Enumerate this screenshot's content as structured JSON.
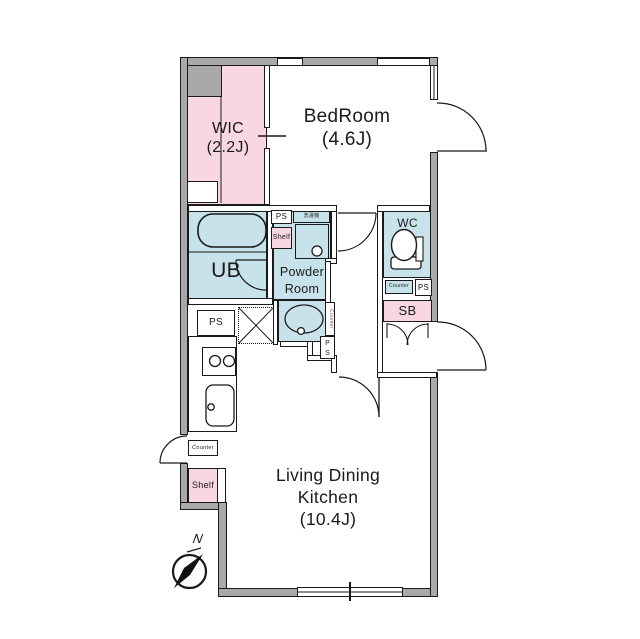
{
  "title": "Apartment floor plan",
  "rooms": {
    "wic": {
      "name": "WIC",
      "size": "(2.2J)"
    },
    "bedroom": {
      "name": "BedRoom",
      "size": "(4.6J)"
    },
    "ub": {
      "name": "UB"
    },
    "powder_room": {
      "line1": "Powder",
      "line2": "Room"
    },
    "wc": {
      "name": "WC"
    },
    "ldk": {
      "line1": "Living Dining",
      "line2": "Kitchen",
      "line3": "(10.4J)"
    }
  },
  "labels": {
    "ps": "PS",
    "p": "P",
    "s": "S",
    "shelf": "Shelf",
    "counter": "Counter",
    "sb": "SB",
    "washer": "洗濯機",
    "north": "N"
  },
  "colors": {
    "wall_gray": "#a9a9a9",
    "room_pink": "#f8d6e2",
    "room_blue": "#c7e2ea",
    "line_black": "#1a1a1a",
    "counter_text_red": "#a0505f"
  }
}
